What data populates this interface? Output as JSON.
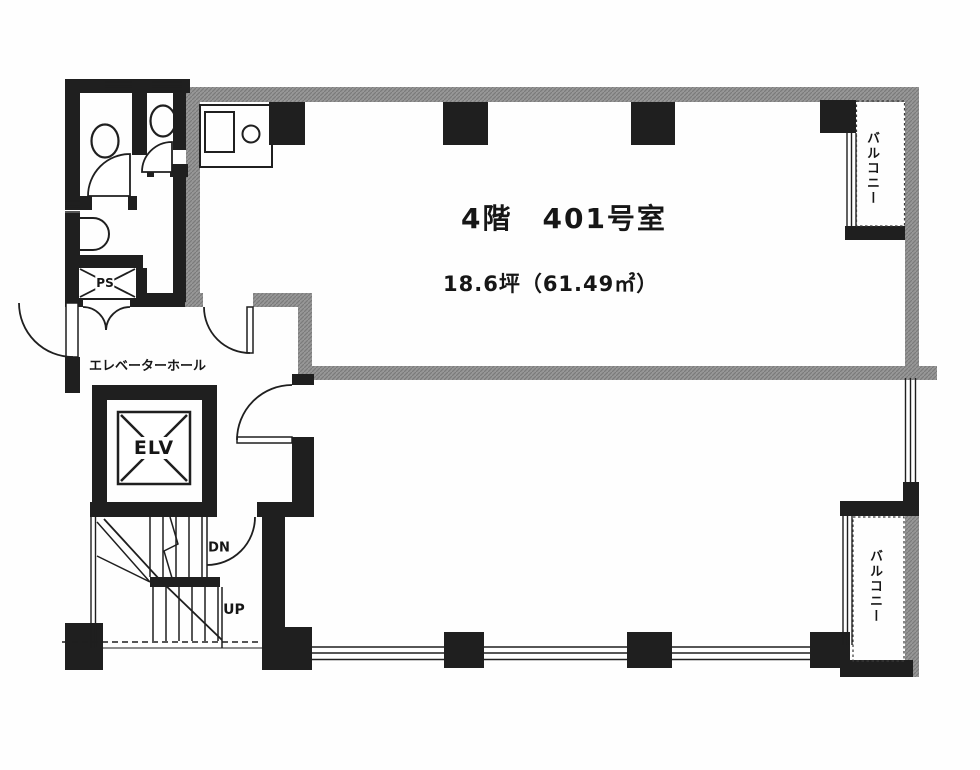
{
  "labels": {
    "title": "4階　401号室",
    "area": "18.6坪（61.49㎡）",
    "elevator_hall": "エレベーターホール",
    "elevator": "ELV",
    "pipe_space": "PS",
    "down": "DN",
    "up": "UP",
    "balcony_top": "バルコニー",
    "balcony_bottom": "バルコニー"
  },
  "colors": {
    "wall_black": "#1f1f1f",
    "wall_gray": "#979797",
    "line": "#1f1f1f",
    "background": "#fefefe"
  }
}
